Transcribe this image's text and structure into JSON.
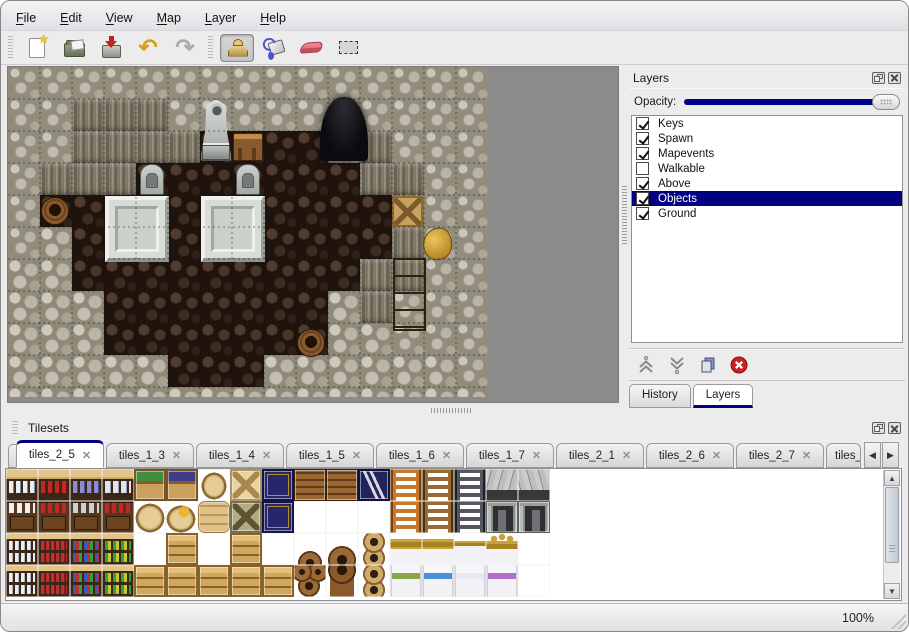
{
  "colors": {
    "accent_navy": "#000080",
    "selection_bg": "#000080",
    "selection_text": "#ffffff",
    "map_outside_gray": "#8b8b8b",
    "undo_yellow": "#d8a018",
    "redo_gray": "#ababab",
    "eraser_pink": "#e26272",
    "delete_red": "#cc1f1f"
  },
  "menubar": {
    "items": [
      {
        "label": "File"
      },
      {
        "label": "Edit"
      },
      {
        "label": "View"
      },
      {
        "label": "Map"
      },
      {
        "label": "Layer"
      },
      {
        "label": "Help"
      }
    ]
  },
  "toolbar": {
    "groups": [
      {
        "buttons": [
          {
            "name": "new"
          },
          {
            "name": "open"
          },
          {
            "name": "save"
          },
          {
            "name": "undo",
            "glyph": "↶"
          },
          {
            "name": "redo",
            "glyph": "↷"
          }
        ]
      },
      {
        "buttons": [
          {
            "name": "stamp",
            "active": true
          },
          {
            "name": "fill"
          },
          {
            "name": "eraser"
          },
          {
            "name": "select"
          }
        ]
      }
    ]
  },
  "map_view": {
    "tile_size": 32,
    "grid": [
      "WWWWWWWWWWWWWWW",
      "WWCCCWWWWWWWWWW",
      "WWCCCCFFFFWCWWW",
      "WCCCFFFFFFFCCWW",
      "WFFFFFFFFFFFCWW",
      "WRFFFFFFFFFFCWW",
      "RRFFFFFFFFFCCWW",
      "RRRFFFFFFFRCWWW",
      "RRRFFFFFFFRRWWW",
      "RRRRRFFFRRRRRRW",
      "RRRRRRRRRRRRRRR"
    ],
    "objects": [
      {
        "type": "door",
        "x": 312,
        "y": 30,
        "w": 48,
        "h": 64
      },
      {
        "type": "statue",
        "x": 192,
        "y": 32,
        "w": 32,
        "h": 62
      },
      {
        "type": "desk",
        "x": 225,
        "y": 66,
        "w": 30,
        "h": 28
      },
      {
        "type": "grave",
        "x": 132,
        "y": 97,
        "w": 24,
        "h": 31
      },
      {
        "type": "grave",
        "x": 228,
        "y": 97,
        "w": 24,
        "h": 31
      },
      {
        "type": "platform",
        "x": 97,
        "y": 129,
        "w": 64,
        "h": 66
      },
      {
        "type": "platform",
        "x": 193,
        "y": 129,
        "w": 64,
        "h": 66
      },
      {
        "type": "barrel",
        "x": 33,
        "y": 130,
        "w": 28,
        "h": 28
      },
      {
        "type": "crate",
        "x": 384,
        "y": 129,
        "w": 31,
        "h": 31
      },
      {
        "type": "goldbag",
        "x": 415,
        "y": 161,
        "w": 29,
        "h": 32
      },
      {
        "type": "cabinet",
        "x": 385,
        "y": 191,
        "w": 33,
        "h": 73
      },
      {
        "type": "barrel",
        "x": 289,
        "y": 262,
        "w": 28,
        "h": 28
      }
    ]
  },
  "layers_panel": {
    "title": "Layers",
    "opacity_label": "Opacity:",
    "opacity_percent": 100,
    "layers": [
      {
        "name": "Keys",
        "checked": true,
        "selected": false
      },
      {
        "name": "Spawn",
        "checked": true,
        "selected": false
      },
      {
        "name": "Mapevents",
        "checked": true,
        "selected": false
      },
      {
        "name": "Walkable",
        "checked": false,
        "selected": false
      },
      {
        "name": "Above",
        "checked": true,
        "selected": false
      },
      {
        "name": "Objects",
        "checked": true,
        "selected": true
      },
      {
        "name": "Ground",
        "checked": true,
        "selected": false
      }
    ],
    "buttons": [
      {
        "name": "move-up"
      },
      {
        "name": "move-down"
      },
      {
        "name": "duplicate"
      },
      {
        "name": "delete"
      }
    ],
    "tabs": [
      {
        "label": "History",
        "active": false
      },
      {
        "label": "Layers",
        "active": true
      }
    ]
  },
  "tilesets_panel": {
    "title": "Tilesets",
    "close_glyph": "✕",
    "scroll_left_glyph": "◀",
    "scroll_right_glyph": "▶",
    "scroll_up_glyph": "▲",
    "scroll_down_glyph": "▼",
    "tabs": [
      {
        "label": "tiles_2_5",
        "active": true,
        "partial": false
      },
      {
        "label": "tiles_1_3",
        "active": false,
        "partial": false
      },
      {
        "label": "tiles_1_4",
        "active": false,
        "partial": false
      },
      {
        "label": "tiles_1_5",
        "active": false,
        "partial": false
      },
      {
        "label": "tiles_1_6",
        "active": false,
        "partial": false
      },
      {
        "label": "tiles_1_7",
        "active": false,
        "partial": false
      },
      {
        "label": "tiles_2_1",
        "active": false,
        "partial": false
      },
      {
        "label": "tiles_2_6",
        "active": false,
        "partial": false
      },
      {
        "label": "tiles_2_7",
        "active": false,
        "partial": false
      },
      {
        "label": "tiles_",
        "active": false,
        "partial": true
      }
    ],
    "grid": [
      [
        "shA_w",
        "shA_r",
        "shA_b",
        "shA_j",
        "crveg",
        "crplum",
        "sack",
        "crx",
        "crnavy",
        "planks",
        "planks",
        "crz",
        "lado",
        "ladb",
        "ladi",
        "archl",
        "archr"
      ],
      [
        "cabA",
        "cabB",
        "cabC",
        "cabB",
        "sackr",
        "sackg",
        "sackp",
        "crx2",
        "crnavy",
        "",
        "",
        "",
        "lado",
        "ladb",
        "ladi",
        "doorl",
        "doorr"
      ],
      [
        "bookw",
        "bookr",
        "bookm",
        "bookg",
        "",
        "crate",
        "",
        "crate",
        "",
        "b3t",
        "bart",
        "pots",
        "bedh",
        "bedh",
        "bedh2",
        "bedcr",
        ""
      ],
      [
        "bookw",
        "bookr",
        "bookm",
        "bookg",
        "crate",
        "crate",
        "crate",
        "crate",
        "crate",
        "b3b",
        "barb",
        "pots",
        "bedg",
        "bedb",
        "bedw",
        "bedp",
        ""
      ]
    ]
  },
  "statusbar": {
    "zoom_level": "100%"
  }
}
